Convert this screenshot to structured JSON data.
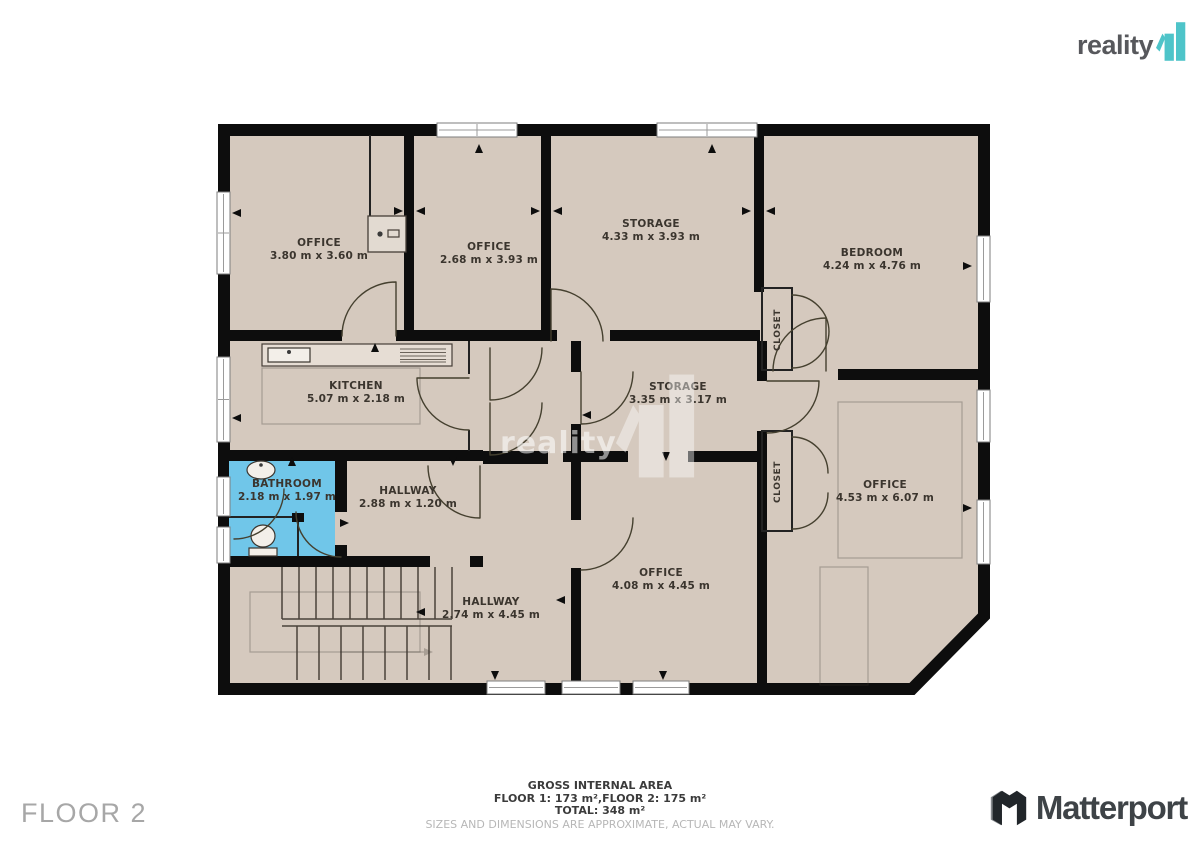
{
  "branding": {
    "reality_logo": {
      "text": "reality",
      "mark": "11",
      "mark_color": "#4ec4c9",
      "text_color": "#57585c"
    },
    "matterport": {
      "text": "Matterport"
    }
  },
  "floor_label": "FLOOR 2",
  "watermark": {
    "text": "reality",
    "mark": "11"
  },
  "footer": {
    "title": "GROSS INTERNAL AREA",
    "areas": "FLOOR 1: 173 m²,FLOOR 2: 175 m²",
    "total": "TOTAL: 348 m²",
    "disclaimer": "SIZES AND DIMENSIONS ARE APPROXIMATE, ACTUAL MAY VARY."
  },
  "plan_colors": {
    "floor": "#d5c9be",
    "wall": "#0d0d0d",
    "bathroom": "#70c6e9"
  },
  "rooms": [
    {
      "id": "office-1",
      "name": "OFFICE",
      "dims": "3.80 m x 3.60 m"
    },
    {
      "id": "office-2",
      "name": "OFFICE",
      "dims": "2.68 m x 3.93 m"
    },
    {
      "id": "storage-1",
      "name": "STORAGE",
      "dims": "4.33 m x 3.93 m"
    },
    {
      "id": "bedroom",
      "name": "BEDROOM",
      "dims": "4.24 m x 4.76 m"
    },
    {
      "id": "kitchen",
      "name": "KITCHEN",
      "dims": "5.07 m x 2.18 m"
    },
    {
      "id": "storage-2",
      "name": "STORAGE",
      "dims": "3.35 m x 3.17 m"
    },
    {
      "id": "bathroom",
      "name": "BATHROOM",
      "dims": "2.18 m x 1.97 m"
    },
    {
      "id": "hallway-1",
      "name": "HALLWAY",
      "dims": "2.88 m x 1.20 m"
    },
    {
      "id": "office-3",
      "name": "OFFICE",
      "dims": "4.53 m x 6.07 m"
    },
    {
      "id": "office-4",
      "name": "OFFICE",
      "dims": "4.08 m x 4.45 m"
    },
    {
      "id": "hallway-2",
      "name": "HALLWAY",
      "dims": "2.74 m x 4.45 m"
    },
    {
      "id": "closet-1",
      "name": "CLOSET"
    },
    {
      "id": "closet-2",
      "name": "CLOSET"
    }
  ]
}
